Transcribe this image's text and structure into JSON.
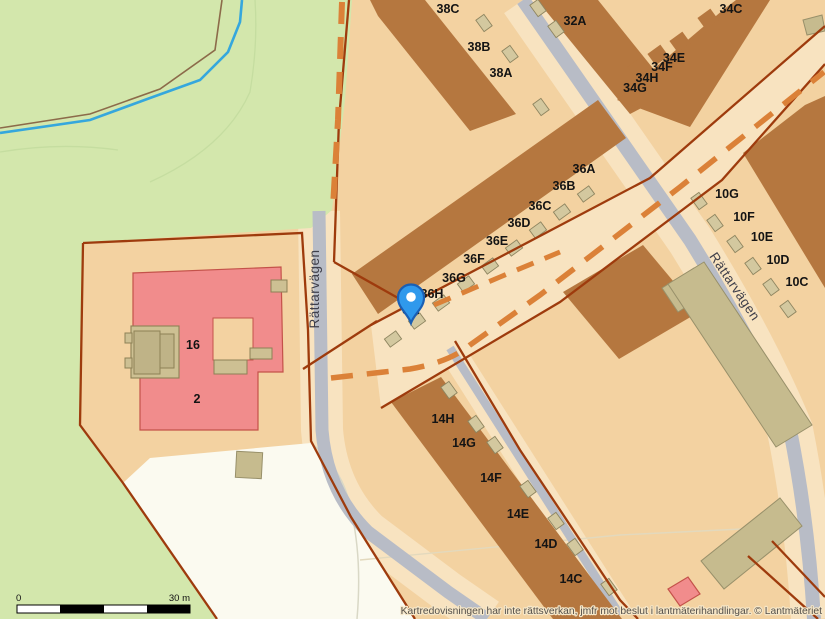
{
  "map": {
    "attribution": "Kartredovisningen har inte rättsverkan, jmfr mot beslut i lantmäterihandlingar. © Lantmäteriet",
    "scale_bar": {
      "start_label": "0",
      "end_label": "30 m"
    },
    "streets": [
      {
        "name": "Rättarvägen",
        "x": 319,
        "y": 289,
        "rotate": -90
      },
      {
        "name": "Rättarvägen",
        "x": 731,
        "y": 289,
        "rotate": 56
      }
    ],
    "house_numbers": [
      {
        "text": "38C",
        "x": 448,
        "y": 13
      },
      {
        "text": "38B",
        "x": 479,
        "y": 51
      },
      {
        "text": "38A",
        "x": 501,
        "y": 77
      },
      {
        "text": "32A",
        "x": 575,
        "y": 25
      },
      {
        "text": "34C",
        "x": 731,
        "y": 13
      },
      {
        "text": "34E",
        "x": 674,
        "y": 62
      },
      {
        "text": "34F",
        "x": 662,
        "y": 71
      },
      {
        "text": "34H",
        "x": 647,
        "y": 82
      },
      {
        "text": "34G",
        "x": 635,
        "y": 92
      },
      {
        "text": "36A",
        "x": 584,
        "y": 173
      },
      {
        "text": "36B",
        "x": 564,
        "y": 190
      },
      {
        "text": "36C",
        "x": 540,
        "y": 210
      },
      {
        "text": "36D",
        "x": 519,
        "y": 227
      },
      {
        "text": "36E",
        "x": 497,
        "y": 245
      },
      {
        "text": "36F",
        "x": 474,
        "y": 263
      },
      {
        "text": "36G",
        "x": 454,
        "y": 282
      },
      {
        "text": "36H",
        "x": 432,
        "y": 298
      },
      {
        "text": "36I",
        "x": 411,
        "y": 314
      },
      {
        "text": "10G",
        "x": 727,
        "y": 198
      },
      {
        "text": "10F",
        "x": 744,
        "y": 221
      },
      {
        "text": "10E",
        "x": 762,
        "y": 241
      },
      {
        "text": "10D",
        "x": 778,
        "y": 264
      },
      {
        "text": "10C",
        "x": 797,
        "y": 286
      },
      {
        "text": "14H",
        "x": 443,
        "y": 423
      },
      {
        "text": "14G",
        "x": 464,
        "y": 447
      },
      {
        "text": "14F",
        "x": 491,
        "y": 482
      },
      {
        "text": "14E",
        "x": 518,
        "y": 518
      },
      {
        "text": "14D",
        "x": 546,
        "y": 548
      },
      {
        "text": "14C",
        "x": 571,
        "y": 583
      },
      {
        "text": "16",
        "x": 193,
        "y": 349
      },
      {
        "text": "2",
        "x": 197,
        "y": 403
      }
    ],
    "marker": {
      "type": "location-pin",
      "x": 411,
      "y": 299
    },
    "colors": {
      "parcel_beige": "#f3d2a1",
      "light_beige": "#f8e3c0",
      "park_green": "#d3e7ac",
      "building_brown": "#b5773f",
      "building_pink": "#f18c8c",
      "building_khaki": "#c6bb8e",
      "boundary_red": "#9e3b0d",
      "easement_orange": "#db8138",
      "road_gray": "#b8bcc6",
      "stream_blue": "#35a7dd",
      "pin_blue": "#2f99ec"
    }
  }
}
